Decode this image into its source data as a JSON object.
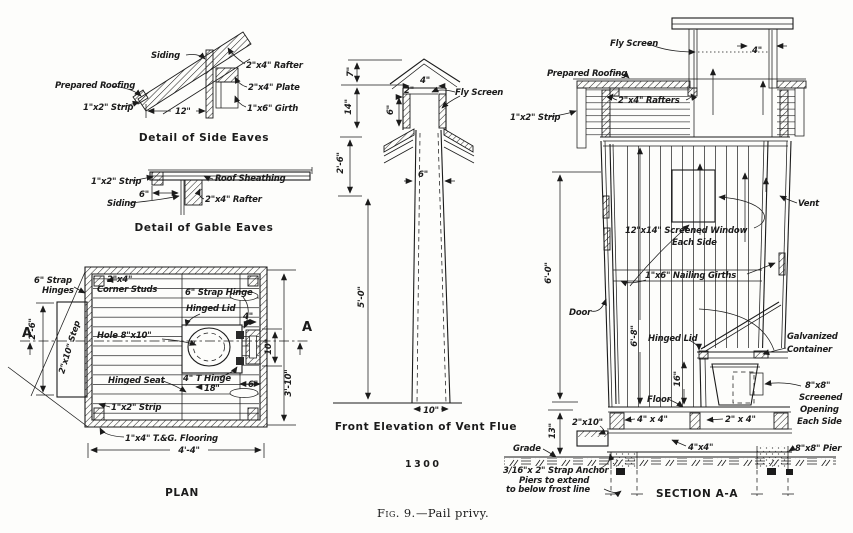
{
  "colors": {
    "ink": "#1b1b1b",
    "paper": "#fdfdfb"
  },
  "figure": {
    "caption_prefix": "Fig. 9.",
    "caption_text": "—Pail privy.",
    "plate_number": "1300"
  },
  "side_eaves": {
    "title": "Detail of Side Eaves",
    "labels": {
      "prepared_roofing": "Prepared Roofing",
      "siding": "Siding",
      "strip": "1\"x2\" Strip",
      "dim_12": "12\"",
      "rafter": "2\"x4\" Rafter",
      "plate": "2\"x4\" Plate",
      "girth": "1\"x6\" Girth"
    }
  },
  "gable_eaves": {
    "title": "Detail of Gable Eaves",
    "labels": {
      "strip": "1\"x2\" Strip",
      "siding": "Siding",
      "dim_6": "6\"",
      "roof_sheathing": "Roof Sheathing",
      "rafter": "2\"x4\" Rafter"
    }
  },
  "plan": {
    "title": "PLAN",
    "labels": {
      "strap_hinges_line1": "6\" Strap",
      "strap_hinges_line2": "Hinges",
      "corner_studs_line1": "2\"x4\"",
      "corner_studs_line2": "Corner Studs",
      "strap_hinge": "6\" Strap Hinge",
      "hinged_lid": "Hinged Lid",
      "dim_4": "4\"",
      "hole": "Hole 8\"x10\"",
      "marker_a_left": "A",
      "marker_a_right": "A",
      "dim_2_6": "2'-6\"",
      "step": "2\"x10\" Step",
      "hinged_seat": "Hinged Seat",
      "t_hinge": "4\" T Hinge",
      "dim_18": "18\"",
      "dim_6": "6\"",
      "dim_10": "10\"",
      "dim_3_10": "3'-10\"",
      "strip": "1\"x2\" Strip",
      "flooring": "1\"x4\" T.&G. Flooring",
      "dim_4_4": "4'-4\""
    }
  },
  "vent_flue": {
    "title": "Front Elevation of Vent Flue",
    "labels": {
      "dim_7": "7\"",
      "dim_4": "4\"",
      "dim_2": "2\"",
      "fly_screen": "Fly Screen",
      "dim_6_top": "6\"",
      "dim_14": "14\"",
      "dim_2_6": "2'-6\"",
      "dim_6_mid": "6\"",
      "dim_5_0": "5'-0\"",
      "dim_10": "10\""
    }
  },
  "section": {
    "title": "SECTION A-A",
    "labels": {
      "fly_screen": "Fly Screen",
      "dim_4": "4\"",
      "prepared_roofing": "Prepared Roofing",
      "rafters": "2\"x4\" Rafters",
      "strip": "1\"x2\" Strip",
      "vent": "Vent",
      "window_line1": "12\"x14\" Screened Window",
      "window_line2": "Each Side",
      "girths": "1\"x6\" Nailing Girths",
      "dim_6_0": "6'-0\"",
      "door": "Door",
      "dim_6_8": "6'-8\"",
      "hinged_lid": "Hinged Lid",
      "galvanized_line1": "Galvanized",
      "galvanized_line2": "Container",
      "dim_16": "16\"",
      "floor": "Floor",
      "opening_line1": "8\"x8\"",
      "opening_line2": "Screened",
      "opening_line3": "Opening",
      "opening_line4": "Each Side",
      "joist_2x10": "2\"x10\"",
      "sill_4x4": "4\" x 4\"",
      "joist_2x4": "2\" x 4\"",
      "dim_13": "13\"",
      "grade": "Grade",
      "skid_4x4": "4\"x4\"",
      "pier": "8\"x8\" Pier",
      "strap_anchor": "3/16\"x 2\" Strap Anchor",
      "piers_note_line1": "Piers to extend",
      "piers_note_line2": "to below frost line"
    }
  }
}
